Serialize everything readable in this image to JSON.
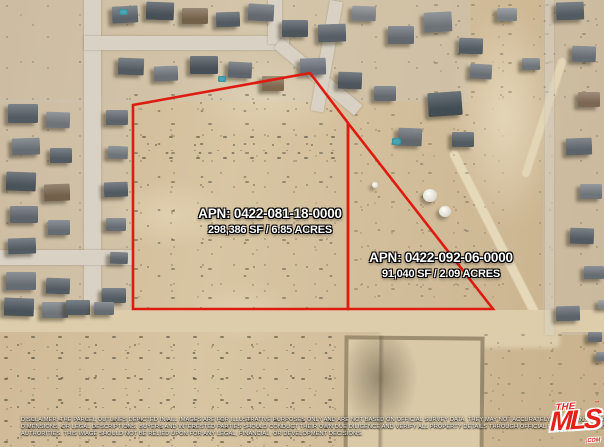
{
  "map": {
    "parcels": [
      {
        "apn": "APN: 0422-081-18-0000",
        "size": "298,386 SF / 6.85 ACRES"
      },
      {
        "apn": "APN: 0422-092-06-0000",
        "size": "91,040 SF / 2.09 ACRES"
      }
    ]
  },
  "disclaimer": {
    "line1": "DISCLAIMER: THE PARCEL OUTLINES DEPICTED IN ALL IMAGES ARE FOR ILLUSTRATIVE PURPOSES ONLY AND ARE NOT BASED ON OFFICIAL SURVEY DATA. THEY MAY NOT ACCURATELY REPRESENT PROPERTY B",
    "line2": "DIMENSIONS, OR LEGAL DESCRIPTIONS. BUYERS AND INTERESTED PARTIES SHOULD CONDUCT THEIR OWN DUE DILIGENCE AND VERIFY ALL PROPERTY DETAILS THROUGH OFFICIAL RECORDS, SURVEYS, AND A",
    "line3": "AUTHORITIES. THIS IMAGE SHOULD NOT BE RELIED UPON FOR ANY LEGAL, FINANCIAL, OR DEVELOPMENT DECISIONS."
  },
  "logo": {
    "the": "THE",
    "mls": "MLS",
    "tm": "™",
    "com": ".COM"
  },
  "colors": {
    "outline_red": "#de1b10",
    "logo_red": "#e32119",
    "label_white": "#ffffff"
  }
}
